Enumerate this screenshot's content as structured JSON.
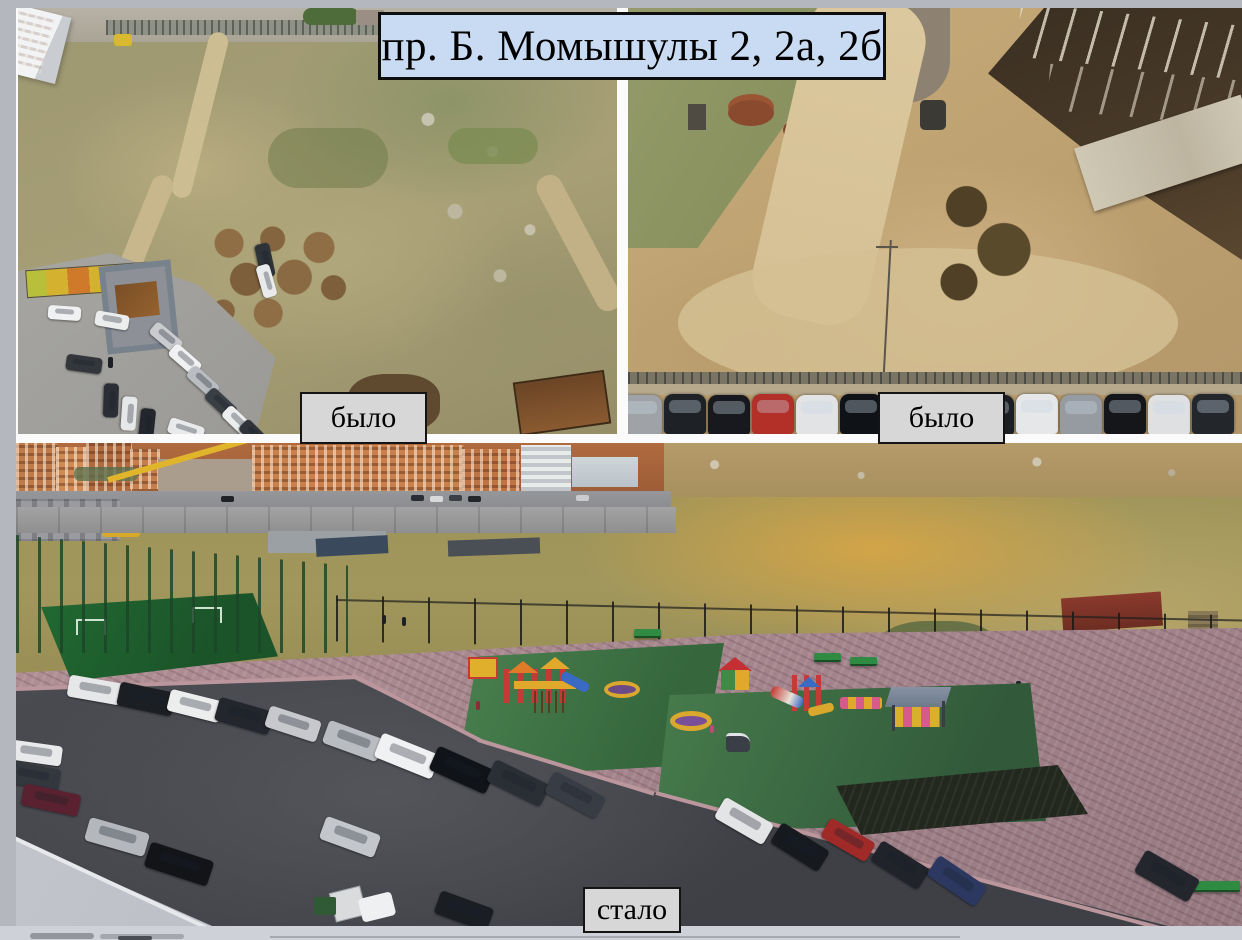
{
  "page": {
    "background_color": "#b4b7bd",
    "gap_color": "#fbfbfb",
    "bottom_strip_color": "#ced1d7"
  },
  "banner": {
    "text": "пр. Б. Момышулы 2, 2а, 2б",
    "background_color": "#c9dbf2",
    "border_color": "#0e0e0e",
    "text_color": "#000000"
  },
  "labels": {
    "background_color": "#d7d7d7",
    "border_color": "#141414",
    "text_color": "#000000"
  },
  "photos": [
    {
      "id": "before-left",
      "label": "было",
      "description": "Aerial photo: vacant weedy lot with dirt tracks, manure piles, rubbish, garbage bins and a car park below an apartment block (before)"
    },
    {
      "id": "before-right",
      "label": "было",
      "description": "Aerial photo: graded bare earth with dirt road, flooded excavation pit with concrete piles, and a row of parked cars (before)"
    },
    {
      "id": "after",
      "label": "стало",
      "description": "Aerial photo: finished courtyard with paved plaza, two playgrounds on green turf, fenced sports field, benches, gazebo and full car parking (after)"
    }
  ]
}
